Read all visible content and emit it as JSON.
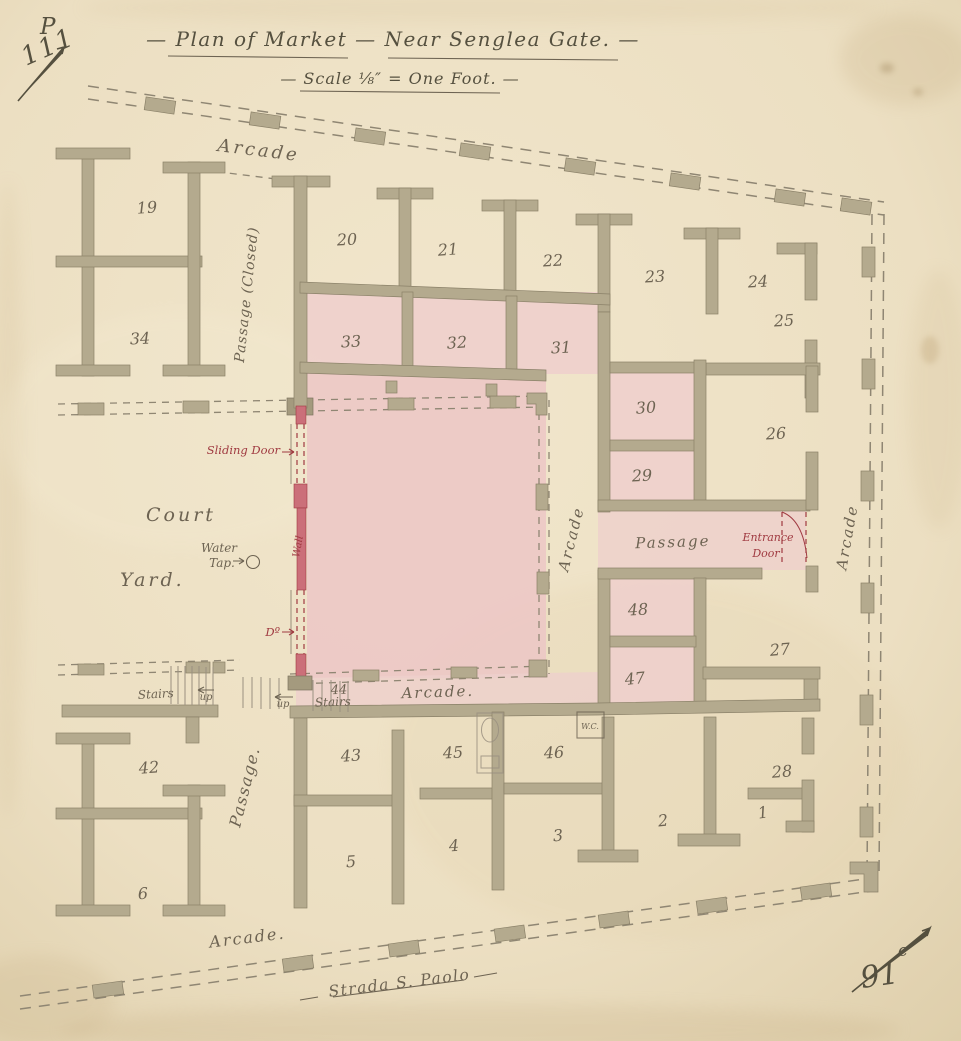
{
  "document": {
    "title": "— Plan of Market — Near Senglea Gate. —",
    "scale_note": "— Scale ⅛″ = One Foot. —",
    "street_name": "Strada S. Paolo",
    "corner_mark_top_left": {
      "number": "111",
      "letter": "P"
    },
    "corner_mark_bottom_right": {
      "number": "91",
      "letter": "c"
    }
  },
  "labels": {
    "arcade_top": "Arcade",
    "arcade_center": "Arcade",
    "arcade_right": "Arcade",
    "arcade_mid": "Arcade.",
    "arcade_bottom": "Arcade.",
    "passage_closed": "Passage (Closed)",
    "passage_center": "Passage",
    "passage_left": "Passage.",
    "court": "Court",
    "yard": "Yard.",
    "water_tap_line1": "Water",
    "water_tap_line2": "Tap.",
    "sliding_door": "Sliding Door",
    "wall_note": "Wall",
    "ditto_door": "Dº",
    "entrance_door_line1": "Entrance",
    "entrance_door_line2": "Door",
    "stairs_left": "Stairs",
    "stairs_market": "Stairs",
    "up_left": "up",
    "up_market": "up",
    "wc": "W.C."
  },
  "rooms": {
    "r19": "19",
    "r34": "34",
    "r20": "20",
    "r21": "21",
    "r22": "22",
    "r23": "23",
    "r24": "24",
    "r25": "25",
    "r33": "33",
    "r32": "32",
    "r31": "31",
    "r30": "30",
    "r29": "29",
    "r26": "26",
    "r48": "48",
    "r47": "47",
    "r27": "27",
    "r28": "28",
    "r42": "42",
    "r6": "6",
    "r43": "43",
    "r5": "5",
    "r44": "44",
    "r45": "45",
    "r4": "4",
    "r46": "46",
    "r3": "3",
    "r2": "2",
    "r1": "1"
  },
  "colors": {
    "paper": "#eee3c8",
    "paper_edge": "#ddcda9",
    "pencil": "#6d6352",
    "pencil_dark": "#55503f",
    "wall": "#b4aa8e",
    "dash": "#8f8673",
    "pink": "#eecfcc",
    "pink_deep": "#ecc8c5",
    "red": "#a03a41",
    "redwall": "#cb6f79"
  }
}
